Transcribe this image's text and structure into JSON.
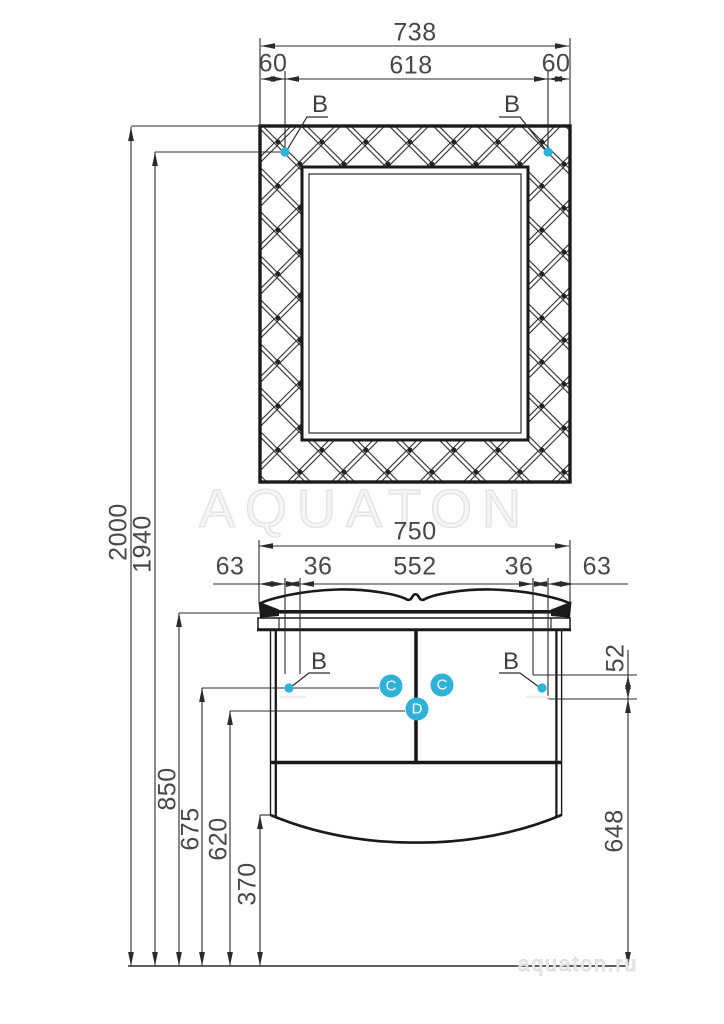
{
  "watermark": {
    "brand": "AQUATON",
    "site": "aquaton.ru"
  },
  "markers": {
    "b": "B",
    "c": "C",
    "d": "D"
  },
  "colors": {
    "accent": "#2eb2d9",
    "line": "#222222",
    "dim_text": "#474747",
    "watermark": "#e2e2e2"
  },
  "dims": {
    "mirror_overall_width": "738",
    "mirror_left_offset": "60",
    "mirror_hole_span": "618",
    "mirror_right_offset": "60",
    "cabinet_overall_width": "750",
    "cabinet_left_overhang": "63",
    "cabinet_left_inset": "36",
    "cabinet_hole_span": "552",
    "cabinet_right_inset": "36",
    "cabinet_right_overhang": "63",
    "total_height": "2000",
    "mirror_mount_height": "1940",
    "counter_height": "850",
    "side_hole_height": "675",
    "center_hole_height": "620",
    "bottom_clearance": "370",
    "mount_offset": "52",
    "right_mount_height": "648"
  }
}
